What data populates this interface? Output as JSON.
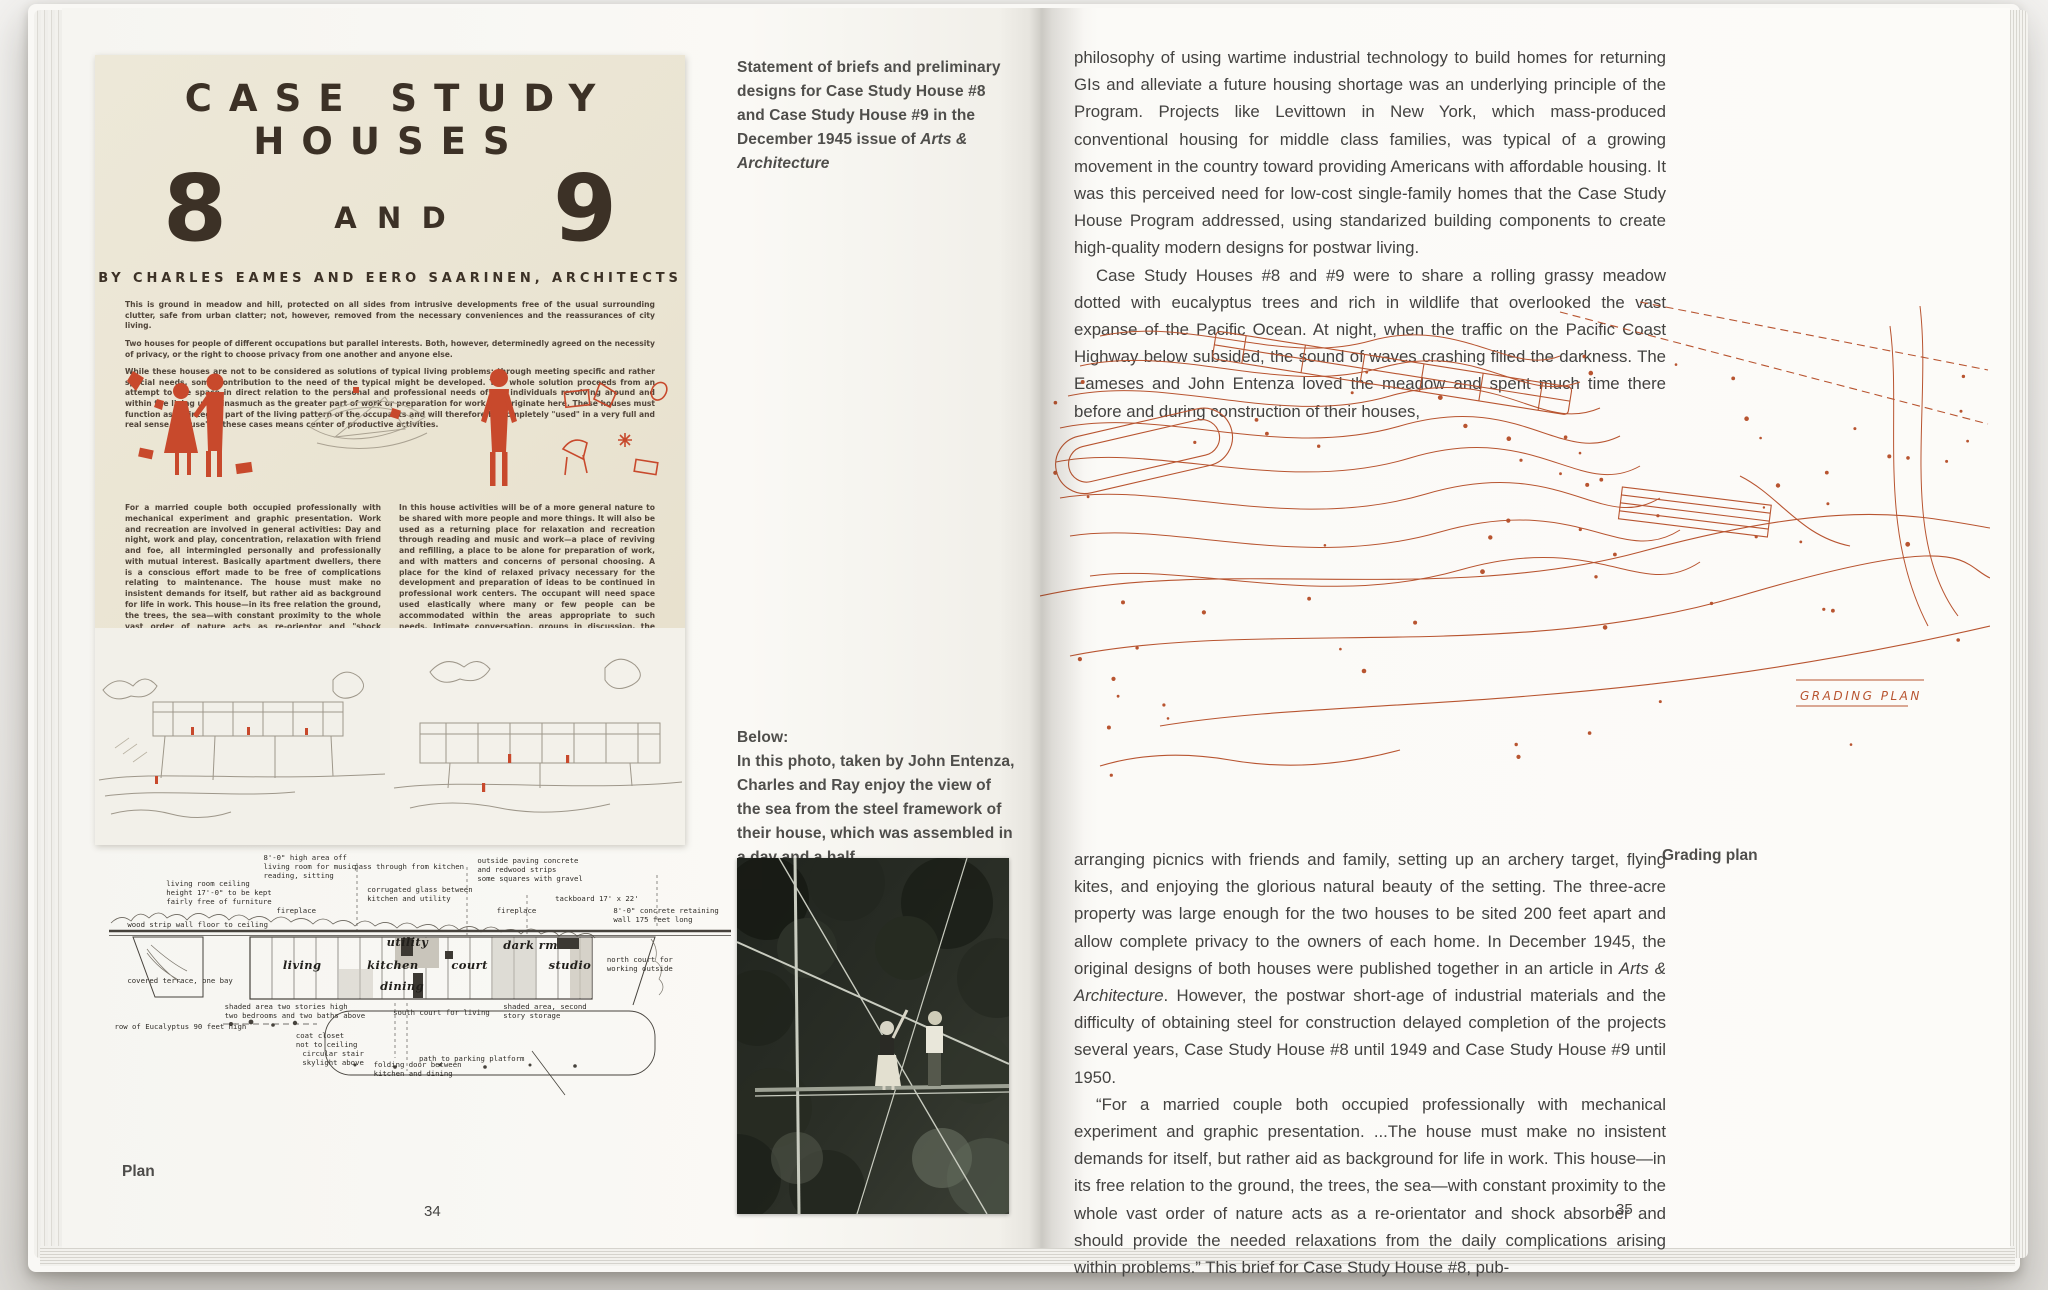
{
  "left_page": {
    "magazine": {
      "title": "CASE STUDY HOUSES",
      "number_8": "8",
      "number_and": "AND",
      "number_9": "9",
      "byline": "BY CHARLES EAMES AND EERO SAARINEN, ARCHITECTS",
      "intro_paragraphs": [
        "This is ground in meadow and hill, protected on all sides from intrusive developments free of the usual surrounding clutter, safe from urban clatter; not, however, removed from the necessary conveniences and the reassurances of city living.",
        "Two houses for people of different occupations but parallel interests. Both, however, determinedly agreed on the necessity of privacy, or the right to choose privacy from one another and anyone else.",
        "While these houses are not to be considered as solutions of typical living problems; through meeting specific and rather special needs, some contribution to the need of the typical might be developed. The whole solution proceeds from an attempt to use space in direct relation to the personal and professional needs of the individuals revolving around and within the living units inasmuch as the greater part of work or preparation for work will originate here. These houses must function as an integral part of the living pattern of the occupants and will therefore be completely \"used\" in a very full and real sense. \"House\" in these cases means center of productive activities."
      ],
      "column_left": "For a married couple both occupied professionally with mechanical experiment and graphic presentation. Work and recreation are involved in general activities: Day and night, work and play, concentration, relaxation with friend and foe, all intermingled personally and professionally with mutual interest. Basically apartment dwellers, there is a conscious effort made to be free of complications relating to maintenance. The house must make no insistent demands for itself, but rather aid as background for life in work. This house—in its free relation the ground, the trees, the sea—with constant proximity to the whole vast order of nature acts as re-orientor and \"shock absorber\" and should provide the needed relaxations from the daily complications arising within problems.",
      "column_right": "In this house activities will be of a more general nature to be shared with more people and more things. It will also be used as a returning place for relaxation and recreation through reading and music and work—a place of reviving and refilling, a place to be alone for preparation of work, and with matters and concerns of personal choosing. A place for the kind of relaxed privacy necessary for the development and preparation of ideas to be continued in professional work centers. The occupant will need space used elastically where many or few people can be accommodated within the areas appropriate to such needs. Intimate conversation, groups in discussion, the use of a projection machine for amusement and education, and facilities for self-indulgent hobbies, i.e., cooking and the entertainment of very close friends."
    },
    "captions": {
      "top_text": "Statement of briefs and preliminary designs for Case Study House #8 and Case Study House #9 in the December 1945 issue of ",
      "top_italic": "Arts & Architecture",
      "below_label": "Below:",
      "below_text": "In this photo, taken by John Entenza, Charles and Ray enjoy the view of the sea from the steel framework of their house, which was assembled in a day and a half."
    },
    "plan": {
      "caption": "Plan",
      "annotations": [
        {
          "text": "8'-0\" high area off\nliving room for music\nreading, sitting",
          "x": 26,
          "y": 0,
          "w": 115
        },
        {
          "text": "living room ceiling\nheight 17'-0\" to be kept\nfairly free of furniture",
          "x": 11,
          "y": 9,
          "w": 130
        },
        {
          "text": "pass through from kitchen",
          "x": 40,
          "y": 3,
          "w": 160
        },
        {
          "text": "corrugated glass between\nkitchen and utility",
          "x": 42,
          "y": 11,
          "w": 145
        },
        {
          "text": "outside paving concrete\nand redwood strips\nsome squares with gravel",
          "x": 59,
          "y": 1,
          "w": 145
        },
        {
          "text": "fireplace",
          "x": 28,
          "y": 18,
          "w": 60
        },
        {
          "text": "fireplace",
          "x": 62,
          "y": 18,
          "w": 60
        },
        {
          "text": "tackboard 17' x 22'",
          "x": 71,
          "y": 14,
          "w": 120
        },
        {
          "text": "8'-0\" concrete retaining\nwall 175 feet long",
          "x": 80,
          "y": 18,
          "w": 135
        },
        {
          "text": "wood strip wall floor to ceiling",
          "x": 5,
          "y": 23,
          "w": 185
        },
        {
          "text": "covered terrace, one bay",
          "x": 5,
          "y": 42,
          "w": 150
        },
        {
          "text": "shaded area two stories high\ntwo bedrooms and two baths above",
          "x": 20,
          "y": 51,
          "w": 205
        },
        {
          "text": "south court for living",
          "x": 46,
          "y": 53,
          "w": 140
        },
        {
          "text": "north court for\nworking outside",
          "x": 79,
          "y": 35,
          "w": 100
        },
        {
          "text": "shaded area, second\nstory storage",
          "x": 63,
          "y": 51,
          "w": 130
        },
        {
          "text": "row of Eucalyptus 90 feet high",
          "x": 3,
          "y": 58,
          "w": 190
        },
        {
          "text": "coat closet\nnot to ceiling",
          "x": 31,
          "y": 61,
          "w": 90
        },
        {
          "text": "circular stair\nskylight above",
          "x": 32,
          "y": 67,
          "w": 90
        },
        {
          "text": "folding door between\nkitchen and dining",
          "x": 43,
          "y": 71,
          "w": 135
        },
        {
          "text": "path to parking platform",
          "x": 50,
          "y": 69,
          "w": 165
        }
      ],
      "rooms": [
        {
          "text": "living",
          "x": 29,
          "y": 36
        },
        {
          "text": "utility",
          "x": 45,
          "y": 28
        },
        {
          "text": "kitchen",
          "x": 42,
          "y": 36
        },
        {
          "text": "dining",
          "x": 44,
          "y": 43
        },
        {
          "text": "court",
          "x": 55,
          "y": 36
        },
        {
          "text": "dark rm",
          "x": 63,
          "y": 29
        },
        {
          "text": "studio",
          "x": 70,
          "y": 36
        }
      ]
    },
    "page_number": "34"
  },
  "right_page": {
    "paragraph_1": "philosophy of using wartime industrial technology to build homes for returning GIs and alleviate a future housing shortage was an underlying principle of the Program. Projects like Levittown in New York, which mass-produced conventional housing for middle class families, was typical of a growing movement in the country toward providing Americans with affordable housing. It was this perceived need for low-cost single-family homes that the Case Study House Program addressed, using standarized building components to create high-quality modern designs for postwar living.",
    "paragraph_2": "Case Study Houses #8 and #9 were to share a rolling grassy meadow dotted with eucalyptus trees and rich in wildlife that overlooked the vast expanse of the Pacific Ocean. At night, when the traffic on the Pacific Coast Highway below subsided, the sound of waves crashing filled the darkness. The Eameses and John Entenza loved the meadow and spent much time there before and during construction of their houses,",
    "paragraph_3_pre": "arranging picnics with friends and family, setting up an archery target, flying kites, and enjoying the glorious natural beauty of the setting. The three-acre property was large enough for the two houses to be sited 200 feet apart and allow complete privacy to the owners of each home. In December 1945, the original designs of both houses were published together in an article in ",
    "paragraph_3_italic": "Arts & Architecture",
    "paragraph_3_post": ". However, the postwar short-age of industrial materials and the difficulty of obtaining steel for construction delayed completion of the projects several years, Case Study House #8 until 1949 and Case Study House #9 until 1950.",
    "paragraph_4": "“For a married couple both occupied professionally with mechanical experiment and graphic presentation. ...The house must make no insistent demands for itself, but rather aid as background for life in work. This house—in its free relation to the ground, the trees, the sea—with constant proximity to the whole vast order of nature acts as a re-orientator and shock absorber and should provide the needed relaxations from the daily complications arising within problems.” This brief for Case Study House #8, pub-",
    "grading_plan_caption": "Grading plan",
    "grading_plan_title_block": "GRADING PLAN",
    "page_number": "35"
  },
  "colors": {
    "magazine_red": "#c8492c",
    "magazine_paper": "#ebe5d4",
    "grading_plan_ink": "#b85430",
    "text_gray": "#434240"
  }
}
